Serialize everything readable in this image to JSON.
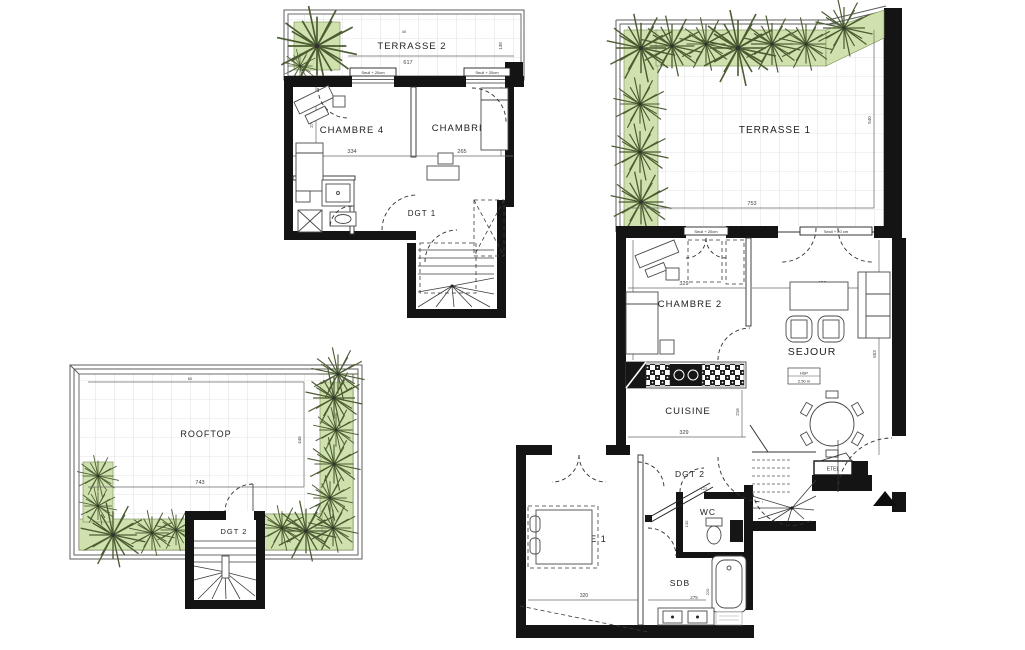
{
  "document_type": "architectural floor plan (duplex apartment with terraces and rooftop)",
  "upper_plan": {
    "terrasse2": {
      "label": "TERRASSE 2",
      "dim_width": "617",
      "dim_top": "40",
      "dim_side": "138"
    },
    "threshold_left": "Seuil + 20cm",
    "threshold_right": "Seuil + 20cm",
    "chambre4": {
      "label": "CHAMBRE 4",
      "dim_width": "334",
      "dim_height": "279"
    },
    "chambre3": {
      "label": "CHAMBRE 3",
      "dim_width": "265",
      "dim_height": "327"
    },
    "sde": {
      "label": "SDE"
    },
    "dgt1": {
      "label": "DGT 1"
    }
  },
  "rooftop_plan": {
    "rooftop": {
      "label": "ROOFTOP",
      "dim_width": "743",
      "dim_height": "446",
      "dim_top": "60"
    },
    "dgt2": {
      "label": "DGT 2"
    }
  },
  "main_plan": {
    "terrasse1": {
      "label": "TERRASSE 1",
      "dim_width": "753",
      "dim_height": "540"
    },
    "threshold_left": "Seuil + 20cm",
    "threshold_right": "Seuil + 20 cm",
    "chambre2": {
      "label": "CHAMBRE 2",
      "dim_width": "329",
      "dim_height": "370"
    },
    "sejour": {
      "label": "SEJOUR",
      "dim_width": "430",
      "dim_height": "653",
      "hsp_title": "HSP",
      "hsp_value": "2.50 m"
    },
    "cuisine": {
      "label": "CUISINE",
      "dim_width": "329",
      "dim_height": "216"
    },
    "dgt2": {
      "label": "DGT 2"
    },
    "chambre1": {
      "label": "CHAMBRE 1",
      "dim_width": "320"
    },
    "wc": {
      "label": "WC",
      "dim_width": "122",
      "dim_height": "130"
    },
    "sdb": {
      "label": "SDB",
      "dim_width": "275",
      "dim_height": "220"
    },
    "etel": {
      "label": "ETEL"
    }
  },
  "colors": {
    "wall": "#141414",
    "planting": "#cfe2ad",
    "tile_grid": "#c9c9c9"
  }
}
